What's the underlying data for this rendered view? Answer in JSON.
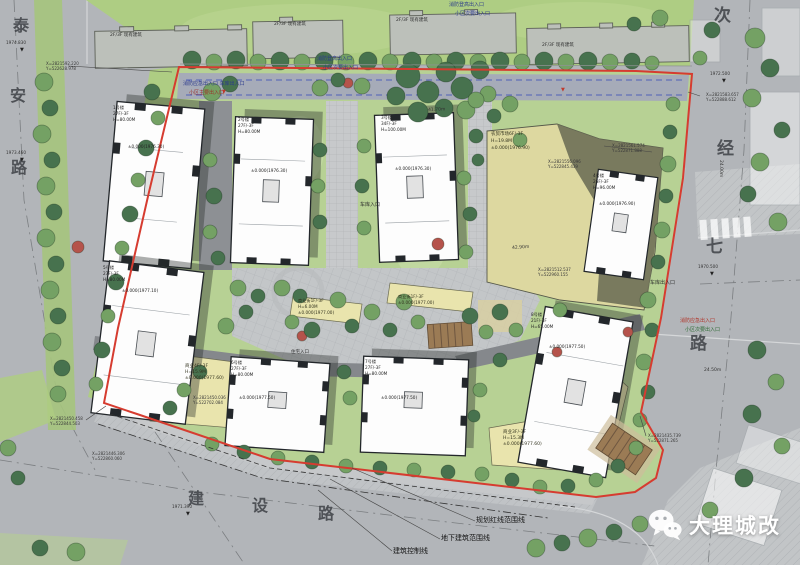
{
  "watermark": {
    "name": "大理城改"
  },
  "roads": {
    "west": "泰安路",
    "east": "次经七路",
    "south": "建设路"
  },
  "site": {
    "existing_buildings_note": "2F/3F 现有建筑",
    "boundary_legend": [
      "规划红线范围线",
      "地下建筑范围线",
      "建筑控制线"
    ],
    "towers": [
      {
        "no": "1号楼",
        "floors": "27F/-3F",
        "height": "H=80.00M",
        "elevation": "±0.000(1976.30)"
      },
      {
        "no": "2号楼",
        "floors": "27F/-3F",
        "height": "H=80.00M",
        "elevation": "±0.000(1976.30)"
      },
      {
        "no": "3号楼",
        "floors": "34F/-3F",
        "height": "H=100.00M",
        "elevation": "±0.000(1976.30)"
      },
      {
        "no": "4号楼",
        "floors": "26F/-3F",
        "height": "H=96.00M",
        "elevation": "±0.000(1976.90)"
      },
      {
        "no": "5号楼",
        "floors": "27F/-3F",
        "height": "H=80.00M",
        "elevation": "±0.000(1977.10)"
      },
      {
        "no": "6号楼",
        "floors": "27F/-3F",
        "height": "H=80.00M",
        "elevation": "±0.000(1977.50)"
      },
      {
        "no": "7号楼",
        "floors": "27F/-3F",
        "height": "H=80.00M",
        "elevation": "±0.000(1977.50)"
      },
      {
        "no": "8号楼",
        "floors": "21F/-3F",
        "height": "H=65.00M",
        "elevation": "±0.000(1977.50)"
      }
    ],
    "podiums": [
      {
        "label": "农贸市场6F/-3F",
        "height": "H=19.8M",
        "elevation": "±0.000(1976.90)"
      },
      {
        "label": "商业4F/-3F",
        "height": "H=15.9M",
        "elevation": "±0.000(1977.60)"
      },
      {
        "label": "商业3F/-3F",
        "height": "H=15.3M",
        "elevation": "±0.000(1977.60)"
      },
      {
        "label": "商业街1F/-3F",
        "height": "H=6.00M",
        "elevation": "±0.000(1977.00)"
      }
    ],
    "entrances": [
      "消防应急出入口 车库出入口",
      "小区主要出入口",
      "消防登高出入口",
      "小区次要出入口",
      "车库出入口",
      "车库入口",
      "住宅入口",
      "消防应急出入口",
      "小区次要出入口"
    ],
    "coordinates": [
      {
        "x": "X=2821592.220",
        "y": "Y=522628.978"
      },
      {
        "x": "X=2821583.657",
        "y": "Y=522888.612"
      },
      {
        "x": "X=2821561.574",
        "y": "Y=522871.888"
      },
      {
        "x": "X=2821556.096",
        "y": "Y=522845.439"
      },
      {
        "x": "X=2821512.537",
        "y": "Y=522960.155"
      },
      {
        "x": "X=2821435.739",
        "y": "Y=522871.265"
      },
      {
        "x": "X=2821450.458",
        "y": "Y=522844.503"
      },
      {
        "x": "X=2821446.306",
        "y": "Y=522860.060"
      },
      {
        "x": "X=2821450.036",
        "y": "Y=522702.084"
      }
    ],
    "spot_elevations": [
      "1974.830",
      "1973.460",
      "1972.500",
      "1970.500",
      "1971.390"
    ],
    "dimensions": [
      "24.00m",
      "24.50m",
      "42.90m",
      "41.70m"
    ]
  },
  "colors": {
    "red_line": "#d63c30",
    "lawn": "#b7d194",
    "grass": "#aecd83",
    "road": "#b2b5b9",
    "commercial_yellow": "#e9e4ad",
    "market_tan": "#ddd8a0",
    "market_shadow": "#707258",
    "tower_white": "#fdfdfd",
    "tree_dark": "#47724e",
    "tree_mid": "#74a164"
  },
  "labels": [
    {
      "n": "road-name-taian-char1",
      "t": "泰",
      "x": 13,
      "y": 18,
      "s": 16,
      "c": "#3e4146",
      "cls": "rd"
    },
    {
      "n": "road-name-taian-char2",
      "t": "安",
      "x": 10,
      "y": 88,
      "s": 16,
      "c": "#3e4146",
      "cls": "rd"
    },
    {
      "n": "road-name-taian-char3",
      "t": "路",
      "x": 11,
      "y": 160,
      "s": 16,
      "c": "#3e4146",
      "cls": "rd"
    },
    {
      "n": "road-name-cijingqi-char1",
      "t": "次",
      "x": 714,
      "y": 8,
      "s": 17,
      "c": "#3e4146",
      "cls": "rd"
    },
    {
      "n": "road-name-cijingqi-char2",
      "t": "经",
      "x": 717,
      "y": 141,
      "s": 17,
      "c": "#3e4146",
      "cls": "rd"
    },
    {
      "n": "road-name-cijingqi-char3",
      "t": "七",
      "x": 706,
      "y": 239,
      "s": 17,
      "c": "#3e4146",
      "cls": "rd"
    },
    {
      "n": "road-name-cijingqi-char4",
      "t": "路",
      "x": 690,
      "y": 336,
      "s": 17,
      "c": "#3e4146",
      "cls": "rd"
    },
    {
      "n": "road-name-jianshe-char1",
      "t": "建",
      "x": 188,
      "y": 491,
      "s": 16,
      "c": "#3e4146",
      "cls": "rd"
    },
    {
      "n": "road-name-jianshe-char2",
      "t": "设",
      "x": 252,
      "y": 498,
      "s": 16,
      "c": "#3e4146",
      "cls": "rd"
    },
    {
      "n": "road-name-jianshe-char3",
      "t": "路",
      "x": 318,
      "y": 506,
      "s": 16,
      "c": "#3e4146",
      "cls": "rd"
    },
    {
      "n": "existing-building-label",
      "t": "2F/3F 现有建筑",
      "x": 110,
      "y": 34,
      "s": 4.5,
      "c": "#2c2c2c"
    },
    {
      "n": "existing-building-label",
      "t": "2F/3F 现有建筑",
      "x": 274,
      "y": 23,
      "s": 4.5,
      "c": "#2c2c2c"
    },
    {
      "n": "existing-building-label",
      "t": "2F/3F 现有建筑",
      "x": 396,
      "y": 19,
      "s": 4.5,
      "c": "#2c2c2c"
    },
    {
      "n": "existing-building-label",
      "t": "2F/3F 现有建筑",
      "x": 542,
      "y": 44,
      "s": 4.5,
      "c": "#2c2c2c"
    },
    {
      "n": "entrance-label",
      "t": "消防应急出入口 车库出入口",
      "x": 183,
      "y": 82,
      "s": 5,
      "c": "#2b3a8c"
    },
    {
      "n": "entrance-label",
      "t": "小区主要出入口",
      "x": 189,
      "y": 91,
      "s": 5,
      "c": "#9c2f28"
    },
    {
      "n": "entrance-label",
      "t": "消防登高出入口",
      "x": 317,
      "y": 57,
      "s": 5,
      "c": "#2b3a8c"
    },
    {
      "n": "entrance-label",
      "t": "小区次要出入口",
      "x": 323,
      "y": 66,
      "s": 5,
      "c": "#2b3a8c"
    },
    {
      "n": "entrance-label",
      "t": "消防登高出入口",
      "x": 449,
      "y": 3,
      "s": 5,
      "c": "#2b3a8c"
    },
    {
      "n": "entrance-label",
      "t": "小区次要出入口",
      "x": 455,
      "y": 12,
      "s": 5,
      "c": "#2b3a8c"
    },
    {
      "n": "entrance-label",
      "t": "车库出入口",
      "x": 650,
      "y": 281,
      "s": 5,
      "c": "#2c2c2c"
    },
    {
      "n": "entrance-label",
      "t": "消防应急出入口",
      "x": 680,
      "y": 319,
      "s": 5,
      "c": "#b03328"
    },
    {
      "n": "entrance-label",
      "t": "小区次要出入口",
      "x": 685,
      "y": 328,
      "s": 5,
      "c": "#2e6b34"
    },
    {
      "n": "entrance-label",
      "t": "车库入口",
      "x": 360,
      "y": 203,
      "s": 5,
      "c": "#2c2c2c"
    },
    {
      "n": "entrance-label",
      "t": "住宅入口",
      "x": 291,
      "y": 351,
      "s": 4.5,
      "c": "#2c2c2c"
    },
    {
      "n": "legend-red-line-label",
      "t": "规划红线范围线",
      "x": 476,
      "y": 517,
      "s": 7,
      "c": "#141414"
    },
    {
      "n": "legend-underground-label",
      "t": "地下建筑范围线",
      "x": 441,
      "y": 535,
      "s": 7,
      "c": "#141414"
    },
    {
      "n": "legend-control-line-label",
      "t": "建筑控制线",
      "x": 393,
      "y": 548,
      "s": 7,
      "c": "#141414"
    },
    {
      "n": "tower-1-label",
      "t": "1号楼",
      "x": 113,
      "y": 106,
      "s": 4.2,
      "c": "#242424"
    },
    {
      "n": "tower-1-label",
      "t": "27F/-3F",
      "x": 113,
      "y": 112,
      "s": 4.2,
      "c": "#242424"
    },
    {
      "n": "tower-1-label",
      "t": "H=80.00M",
      "x": 113,
      "y": 118,
      "s": 4.2,
      "c": "#242424"
    },
    {
      "n": "tower-1-elevation",
      "t": "±0.000(1976.30)",
      "x": 128,
      "y": 145,
      "s": 4.2,
      "c": "#242424"
    },
    {
      "n": "tower-2-label",
      "t": "2号楼",
      "x": 238,
      "y": 118,
      "s": 4.2,
      "c": "#242424"
    },
    {
      "n": "tower-2-label",
      "t": "27F/-3F",
      "x": 238,
      "y": 124,
      "s": 4.2,
      "c": "#242424"
    },
    {
      "n": "tower-2-label",
      "t": "H=80.00M",
      "x": 238,
      "y": 130,
      "s": 4.2,
      "c": "#242424"
    },
    {
      "n": "tower-2-elevation",
      "t": "±0.000(1976.30)",
      "x": 251,
      "y": 169,
      "s": 4.2,
      "c": "#242424"
    },
    {
      "n": "tower-3-label",
      "t": "3号楼",
      "x": 381,
      "y": 116,
      "s": 4.2,
      "c": "#242424"
    },
    {
      "n": "tower-3-label",
      "t": "34F/-3F",
      "x": 381,
      "y": 122,
      "s": 4.2,
      "c": "#242424"
    },
    {
      "n": "tower-3-label",
      "t": "H=100.00M",
      "x": 381,
      "y": 128,
      "s": 4.2,
      "c": "#242424"
    },
    {
      "n": "tower-3-elevation",
      "t": "±0.000(1976.30)",
      "x": 395,
      "y": 167,
      "s": 4.2,
      "c": "#242424"
    },
    {
      "n": "tower-4-label",
      "t": "4号楼",
      "x": 593,
      "y": 174,
      "s": 4.2,
      "c": "#242424"
    },
    {
      "n": "tower-4-label",
      "t": "26F/-3F",
      "x": 593,
      "y": 180,
      "s": 4.2,
      "c": "#242424"
    },
    {
      "n": "tower-4-label",
      "t": "H=96.00M",
      "x": 593,
      "y": 186,
      "s": 4.2,
      "c": "#242424"
    },
    {
      "n": "tower-4-elevation",
      "t": "±0.000(1976.90)",
      "x": 599,
      "y": 202,
      "s": 4.2,
      "c": "#242424"
    },
    {
      "n": "tower-5-label",
      "t": "5号楼",
      "x": 103,
      "y": 266,
      "s": 4.2,
      "c": "#242424"
    },
    {
      "n": "tower-5-label",
      "t": "27F/-3F",
      "x": 103,
      "y": 272,
      "s": 4.2,
      "c": "#242424"
    },
    {
      "n": "tower-5-label",
      "t": "H=80.00M",
      "x": 103,
      "y": 278,
      "s": 4.2,
      "c": "#242424"
    },
    {
      "n": "tower-5-elevation",
      "t": "±0.000(1977.10)",
      "x": 122,
      "y": 289,
      "s": 4.2,
      "c": "#242424"
    },
    {
      "n": "tower-6-label",
      "t": "6号楼",
      "x": 231,
      "y": 361,
      "s": 4.2,
      "c": "#242424"
    },
    {
      "n": "tower-6-label",
      "t": "27F/-3F",
      "x": 231,
      "y": 367,
      "s": 4.2,
      "c": "#242424"
    },
    {
      "n": "tower-6-label",
      "t": "H=80.00M",
      "x": 231,
      "y": 373,
      "s": 4.2,
      "c": "#242424"
    },
    {
      "n": "tower-6-elevation",
      "t": "±0.000(1977.50)",
      "x": 239,
      "y": 396,
      "s": 4.2,
      "c": "#242424"
    },
    {
      "n": "tower-7-label",
      "t": "7号楼",
      "x": 365,
      "y": 360,
      "s": 4.2,
      "c": "#242424"
    },
    {
      "n": "tower-7-label",
      "t": "27F/-3F",
      "x": 365,
      "y": 366,
      "s": 4.2,
      "c": "#242424"
    },
    {
      "n": "tower-7-label",
      "t": "H=80.00M",
      "x": 365,
      "y": 372,
      "s": 4.2,
      "c": "#242424"
    },
    {
      "n": "tower-7-elevation",
      "t": "±0.000(1977.50)",
      "x": 381,
      "y": 396,
      "s": 4.2,
      "c": "#242424"
    },
    {
      "n": "tower-8-label",
      "t": "8号楼",
      "x": 531,
      "y": 313,
      "s": 4.2,
      "c": "#242424"
    },
    {
      "n": "tower-8-label",
      "t": "21F/-3F",
      "x": 531,
      "y": 319,
      "s": 4.2,
      "c": "#242424"
    },
    {
      "n": "tower-8-label",
      "t": "H=65.00M",
      "x": 531,
      "y": 325,
      "s": 4.2,
      "c": "#242424"
    },
    {
      "n": "tower-8-elevation",
      "t": "±0.000(1977.50)",
      "x": 549,
      "y": 345,
      "s": 4.2,
      "c": "#242424"
    },
    {
      "n": "market-podium-label",
      "t": "农贸市场6F/-3F",
      "x": 491,
      "y": 133,
      "s": 4.5,
      "c": "#33331f"
    },
    {
      "n": "market-podium-label",
      "t": "H=19.8M",
      "x": 491,
      "y": 140,
      "s": 4.5,
      "c": "#33331f"
    },
    {
      "n": "market-podium-label",
      "t": "±0.000(1976.90)",
      "x": 491,
      "y": 147,
      "s": 4.5,
      "c": "#33331f"
    },
    {
      "n": "commercial-podium-label",
      "t": "商业4F/-3F",
      "x": 185,
      "y": 365,
      "s": 4.5,
      "c": "#33331f"
    },
    {
      "n": "commercial-podium-label",
      "t": "H=15.9M",
      "x": 185,
      "y": 371,
      "s": 4.5,
      "c": "#33331f"
    },
    {
      "n": "commercial-podium-label",
      "t": "±0.000(1977.60)",
      "x": 185,
      "y": 377,
      "s": 4.5,
      "c": "#33331f"
    },
    {
      "n": "commercial-podium-label",
      "t": "商业3F/-3F",
      "x": 503,
      "y": 431,
      "s": 4.5,
      "c": "#33331f"
    },
    {
      "n": "commercial-podium-label",
      "t": "H=15.3M",
      "x": 503,
      "y": 437,
      "s": 4.5,
      "c": "#33331f"
    },
    {
      "n": "commercial-podium-label",
      "t": "±0.000(1977.60)",
      "x": 503,
      "y": 443,
      "s": 4.5,
      "c": "#33331f"
    },
    {
      "n": "commercial-street-label",
      "t": "商业街1F/-3F",
      "x": 298,
      "y": 299,
      "s": 4.2,
      "c": "#33331f"
    },
    {
      "n": "commercial-street-label",
      "t": "H=6.00M",
      "x": 298,
      "y": 305,
      "s": 4.2,
      "c": "#33331f"
    },
    {
      "n": "commercial-street-label",
      "t": "±0.000(1977.00)",
      "x": 298,
      "y": 311,
      "s": 4.2,
      "c": "#33331f"
    },
    {
      "n": "commercial-street-label",
      "t": "商业街1F/-3F",
      "x": 398,
      "y": 295,
      "s": 4.2,
      "c": "#33331f"
    },
    {
      "n": "commercial-street-label",
      "t": "±0.000(1977.00)",
      "x": 398,
      "y": 301,
      "s": 4.2,
      "c": "#33331f"
    },
    {
      "n": "coordinate-label",
      "t": "X=2821592.220",
      "x": 46,
      "y": 62,
      "s": 4,
      "c": "#3a3a3a"
    },
    {
      "n": "coordinate-label",
      "t": "Y=522628.978",
      "x": 46,
      "y": 67,
      "s": 4,
      "c": "#3a3a3a"
    },
    {
      "n": "coordinate-label",
      "t": "X=2821583.657",
      "x": 706,
      "y": 93,
      "s": 4,
      "c": "#3a3a3a"
    },
    {
      "n": "coordinate-label",
      "t": "Y=522888.612",
      "x": 706,
      "y": 98,
      "s": 4,
      "c": "#3a3a3a"
    },
    {
      "n": "coordinate-label",
      "t": "X=2821561.574",
      "x": 612,
      "y": 144,
      "s": 4,
      "c": "#3a3a3a"
    },
    {
      "n": "coordinate-label",
      "t": "Y=522871.888",
      "x": 612,
      "y": 149,
      "s": 4,
      "c": "#3a3a3a"
    },
    {
      "n": "coordinate-label",
      "t": "X=2821556.096",
      "x": 548,
      "y": 160,
      "s": 4,
      "c": "#3a3a3a"
    },
    {
      "n": "coordinate-label",
      "t": "Y=522845.439",
      "x": 548,
      "y": 165,
      "s": 4,
      "c": "#3a3a3a"
    },
    {
      "n": "coordinate-label",
      "t": "X=2821512.537",
      "x": 538,
      "y": 268,
      "s": 4,
      "c": "#3a3a3a"
    },
    {
      "n": "coordinate-label",
      "t": "Y=522960.155",
      "x": 538,
      "y": 273,
      "s": 4,
      "c": "#3a3a3a"
    },
    {
      "n": "coordinate-label",
      "t": "X=2821435.739",
      "x": 648,
      "y": 434,
      "s": 4,
      "c": "#3a3a3a"
    },
    {
      "n": "coordinate-label",
      "t": "Y=522871.265",
      "x": 648,
      "y": 439,
      "s": 4,
      "c": "#3a3a3a"
    },
    {
      "n": "coordinate-label",
      "t": "X=2821450.458",
      "x": 50,
      "y": 417,
      "s": 4,
      "c": "#3a3a3a"
    },
    {
      "n": "coordinate-label",
      "t": "Y=522844.503",
      "x": 50,
      "y": 422,
      "s": 4,
      "c": "#3a3a3a"
    },
    {
      "n": "coordinate-label",
      "t": "X=2821446.306",
      "x": 92,
      "y": 452,
      "s": 4,
      "c": "#3a3a3a"
    },
    {
      "n": "coordinate-label",
      "t": "Y=522860.060",
      "x": 92,
      "y": 457,
      "s": 4,
      "c": "#3a3a3a"
    },
    {
      "n": "coordinate-label",
      "t": "X=2821450.036",
      "x": 193,
      "y": 396,
      "s": 4,
      "c": "#3a3a3a"
    },
    {
      "n": "coordinate-label",
      "t": "Y=522702.084",
      "x": 193,
      "y": 401,
      "s": 4,
      "c": "#3a3a3a"
    },
    {
      "n": "spot-elevation",
      "t": "1974.830",
      "x": 6,
      "y": 41,
      "s": 4.2,
      "c": "#333333"
    },
    {
      "n": "spot-elevation-marker",
      "t": "▼",
      "x": 20,
      "y": 48,
      "s": 5,
      "c": "#222222"
    },
    {
      "n": "spot-elevation",
      "t": "1973.460",
      "x": 6,
      "y": 151,
      "s": 4.2,
      "c": "#333333"
    },
    {
      "n": "spot-elevation-marker",
      "t": "▼",
      "x": 20,
      "y": 158,
      "s": 5,
      "c": "#222222"
    },
    {
      "n": "spot-elevation",
      "t": "1972.500",
      "x": 710,
      "y": 72,
      "s": 4.2,
      "c": "#333333"
    },
    {
      "n": "spot-elevation-marker",
      "t": "▼",
      "x": 722,
      "y": 79,
      "s": 5,
      "c": "#222222"
    },
    {
      "n": "spot-elevation",
      "t": "1970.500",
      "x": 698,
      "y": 265,
      "s": 4.2,
      "c": "#333333"
    },
    {
      "n": "spot-elevation-marker",
      "t": "▼",
      "x": 710,
      "y": 272,
      "s": 5,
      "c": "#222222"
    },
    {
      "n": "spot-elevation",
      "t": "1971.390",
      "x": 172,
      "y": 505,
      "s": 4.2,
      "c": "#333333"
    },
    {
      "n": "spot-elevation-marker",
      "t": "▼",
      "x": 186,
      "y": 512,
      "s": 5,
      "c": "#222222"
    },
    {
      "n": "fire-hydrant-marker",
      "t": "▼",
      "x": 222,
      "y": 90,
      "s": 5,
      "c": "#c0392b"
    },
    {
      "n": "fire-hydrant-marker",
      "t": "▼",
      "x": 561,
      "y": 88,
      "s": 5,
      "c": "#c0392b"
    },
    {
      "n": "dimension-label",
      "t": "24.00m",
      "x": 722,
      "y": 160,
      "s": 4.5,
      "c": "#333333",
      "r": 90
    },
    {
      "n": "dimension-label",
      "t": "24.50m",
      "x": 704,
      "y": 369,
      "s": 4.5,
      "c": "#333333"
    },
    {
      "n": "dimension-label",
      "t": "42.90m",
      "x": 512,
      "y": 247,
      "s": 4.5,
      "c": "#333333",
      "r": -4
    },
    {
      "n": "dimension-label",
      "t": "41.70m",
      "x": 428,
      "y": 109,
      "s": 4.5,
      "c": "#333333",
      "r": -2
    }
  ]
}
